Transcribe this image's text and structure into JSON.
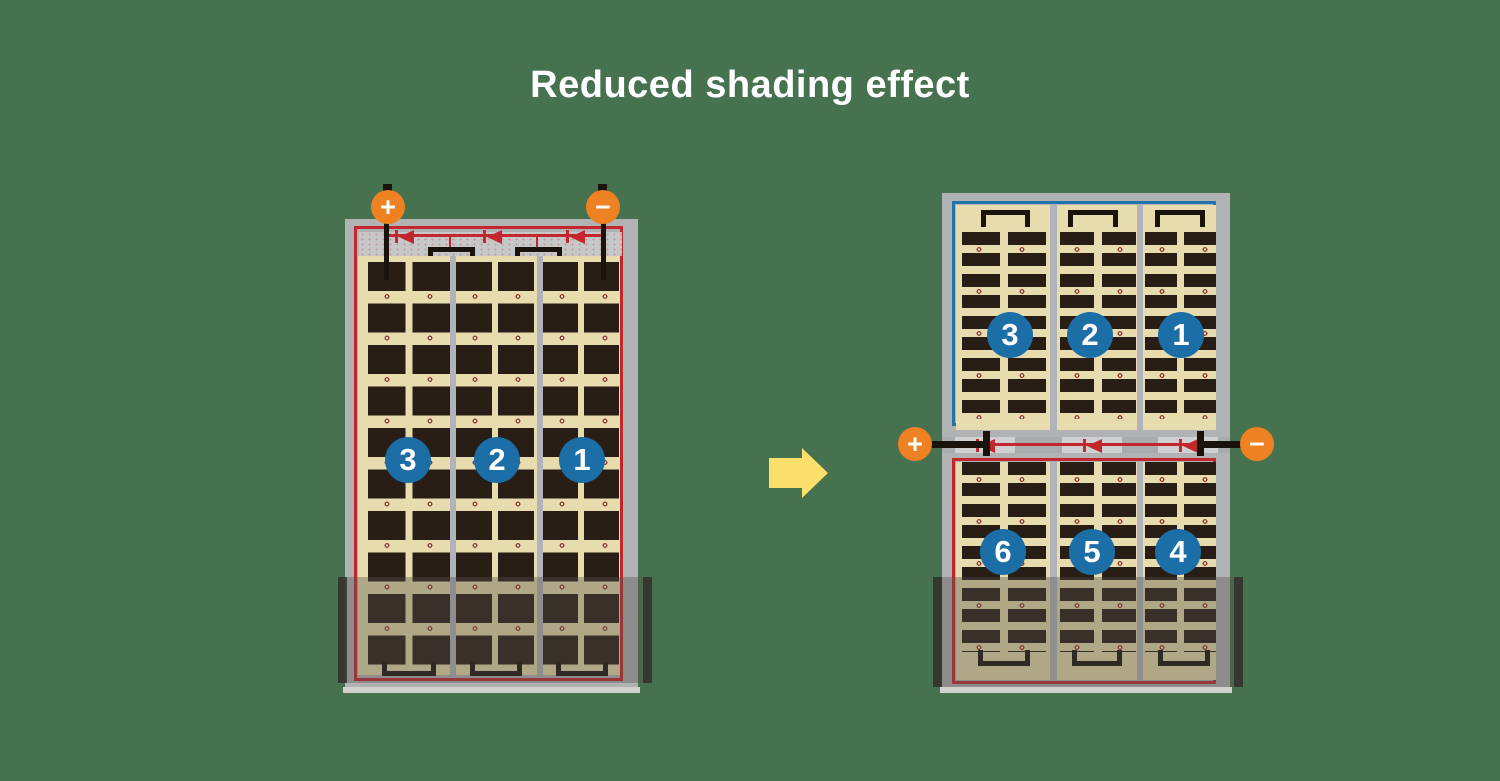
{
  "title": "Reduced shading effect",
  "left_module": {
    "positive_terminal": "+",
    "negative_terminal": "−",
    "cell_strings": [
      "3",
      "2",
      "1"
    ],
    "diode_count": 3
  },
  "right_module": {
    "positive_terminal": "+",
    "negative_terminal": "−",
    "top_cell_strings": [
      "3",
      "2",
      "1"
    ],
    "bottom_cell_strings": [
      "6",
      "5",
      "4"
    ],
    "diode_count": 3
  },
  "colors": {
    "background_green": "#47724f",
    "title_text": "#ffffff",
    "panel_frame_gray": "#b1b2b4",
    "cell_dark": "#281e16",
    "backsheet_tan": "#e7dcad",
    "circuit_border_red": "#c1272d",
    "circuit_border_blue": "#2273aa",
    "terminal_orange": "#ee8122",
    "string_circle_blue": "#1b6ea6",
    "arrow_yellow": "#fcdf6b"
  }
}
